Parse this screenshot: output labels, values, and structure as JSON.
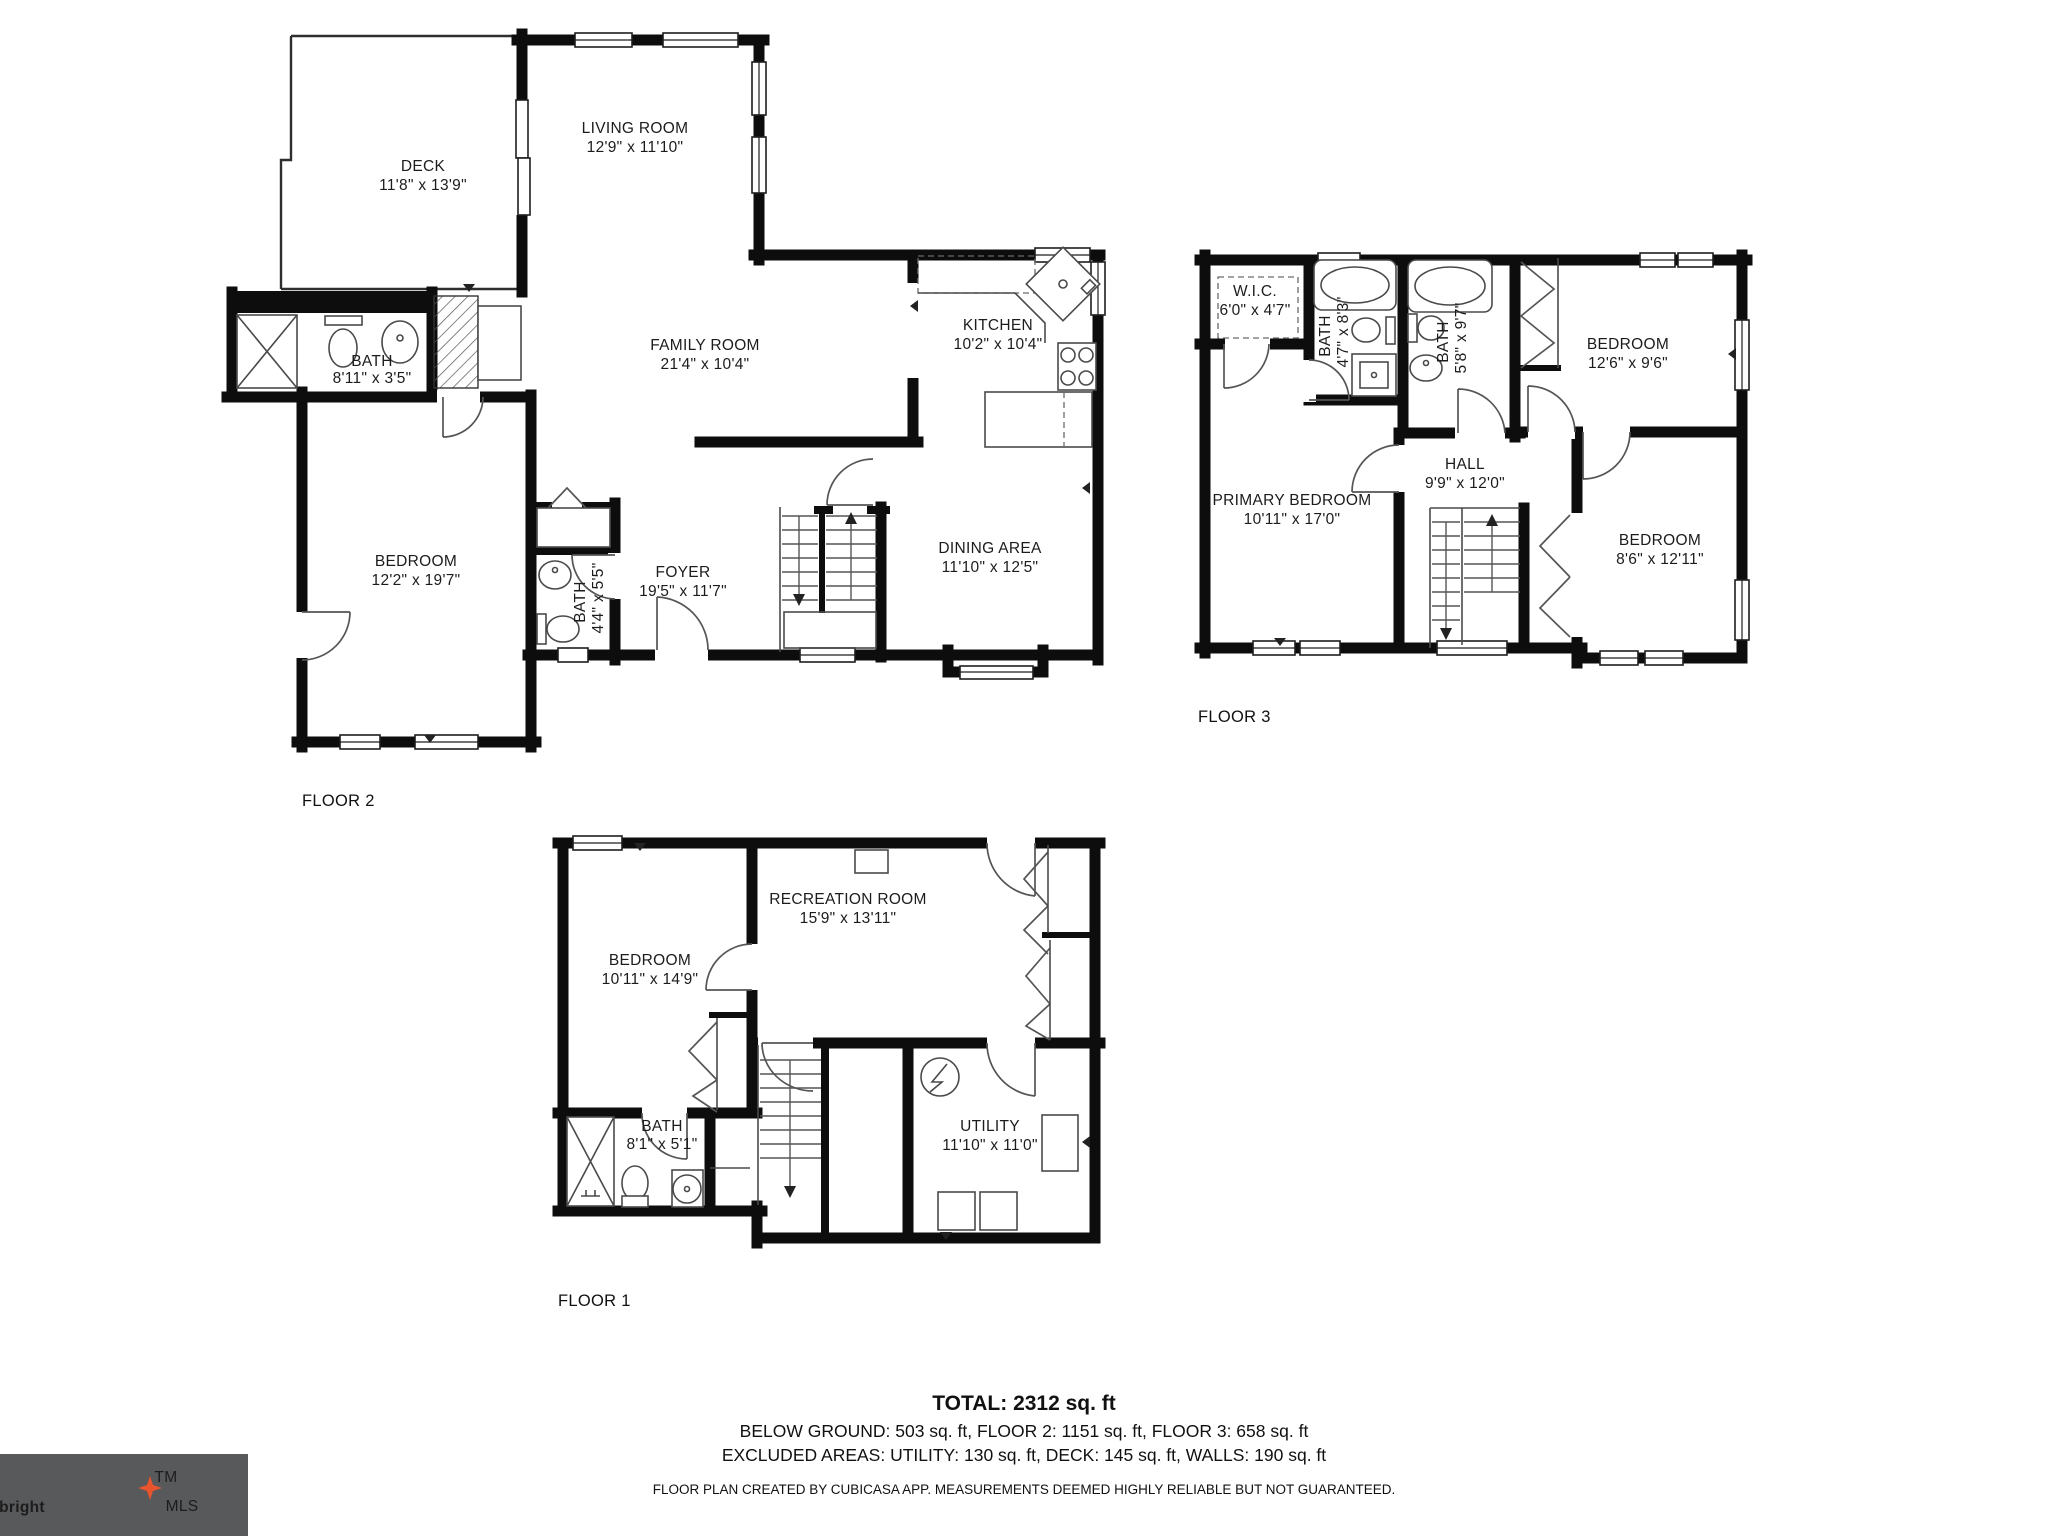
{
  "floors": {
    "floor2": {
      "label": "FLOOR 2",
      "rooms": {
        "deck": {
          "name": "DECK",
          "dims": "11'8\" x 13'9\""
        },
        "living_room": {
          "name": "LIVING ROOM",
          "dims": "12'9\" x 11'10\""
        },
        "family_room": {
          "name": "FAMILY ROOM",
          "dims": "21'4\" x 10'4\""
        },
        "kitchen": {
          "name": "KITCHEN",
          "dims": "10'2\" x 10'4\""
        },
        "bath": {
          "name": "BATH",
          "dims": "8'11\" x 3'5\""
        },
        "bedroom": {
          "name": "BEDROOM",
          "dims": "12'2\" x 19'7\""
        },
        "bath_small": {
          "name": "BATH",
          "dims": "4'4\" x 5'5\""
        },
        "foyer": {
          "name": "FOYER",
          "dims": "19'5\" x 11'7\""
        },
        "dining_area": {
          "name": "DINING AREA",
          "dims": "11'10\" x 12'5\""
        }
      }
    },
    "floor3": {
      "label": "FLOOR 3",
      "rooms": {
        "wic": {
          "name": "W.I.C.",
          "dims": "6'0\" x 4'7\""
        },
        "bath_left": {
          "name": "BATH",
          "dims": "4'7\" x 8'3\""
        },
        "bath_right": {
          "name": "BATH",
          "dims": "5'8\" x 9'7\""
        },
        "bedroom_top": {
          "name": "BEDROOM",
          "dims": "12'6\" x 9'6\""
        },
        "primary_bedroom": {
          "name": "PRIMARY BEDROOM",
          "dims": "10'11\" x 17'0\""
        },
        "hall": {
          "name": "HALL",
          "dims": "9'9\" x 12'0\""
        },
        "bedroom_bottom": {
          "name": "BEDROOM",
          "dims": "8'6\" x 12'11\""
        }
      }
    },
    "floor1": {
      "label": "FLOOR 1",
      "rooms": {
        "bedroom": {
          "name": "BEDROOM",
          "dims": "10'11\" x 14'9\""
        },
        "recreation_room": {
          "name": "RECREATION ROOM",
          "dims": "15'9\" x 13'11\""
        },
        "bath": {
          "name": "BATH",
          "dims": "8'1\" x 5'1\""
        },
        "utility": {
          "name": "UTILITY",
          "dims": "11'10\" x 11'0\""
        }
      }
    }
  },
  "summary": {
    "total": "TOTAL: 2312 sq. ft",
    "areas_line": "BELOW GROUND: 503 sq. ft, FLOOR 2: 1151 sq. ft, FLOOR 3: 658 sq. ft",
    "excluded_line": "EXCLUDED AREAS: UTILITY: 130 sq. ft, DECK: 145 sq. ft, WALLS: 190 sq. ft",
    "disclaimer": "FLOOR PLAN CREATED BY CUBICASA APP. MEASUREMENTS DEEMED HIGHLY RELIABLE BUT NOT GUARANTEED."
  },
  "logo": {
    "brand": "bright",
    "tm": "TM",
    "suffix": "MLS",
    "background": "#58595B",
    "star_color": "#E8542E"
  }
}
